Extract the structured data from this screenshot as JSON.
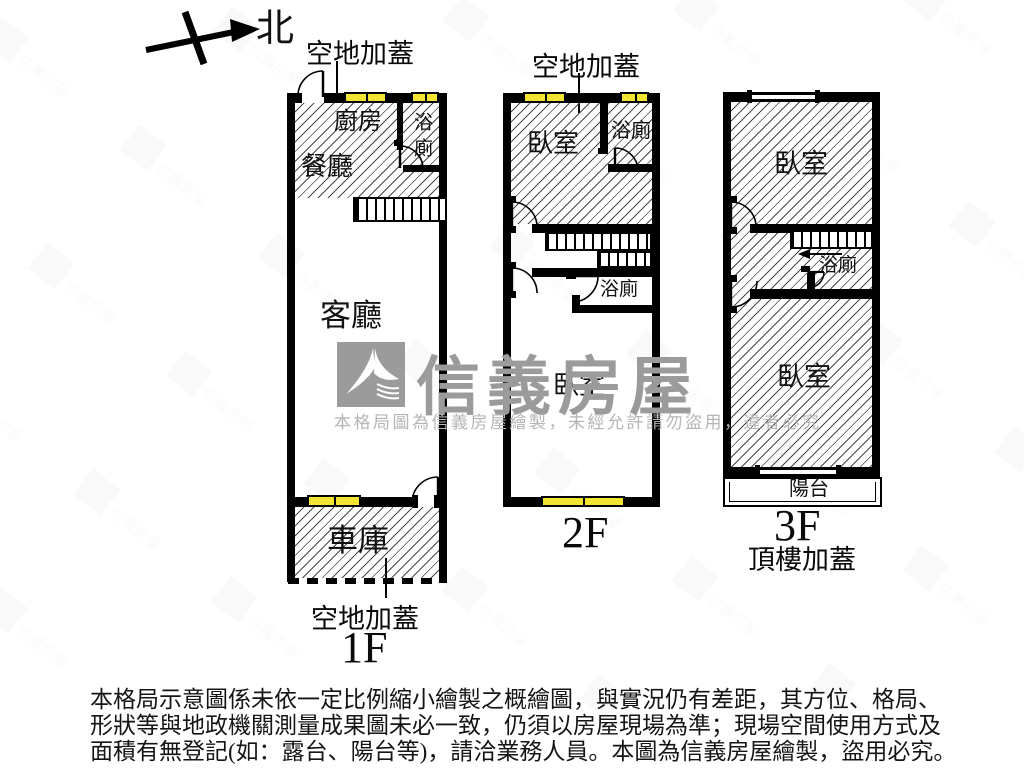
{
  "compass": {
    "north_label": "北"
  },
  "floor1": {
    "label": "1F",
    "annotation_top": "空地加蓋",
    "annotation_bottom": "空地加蓋",
    "rooms": {
      "kitchen": "廚房",
      "bath": "浴廁",
      "dining": "餐廳",
      "living": "客廳",
      "garage": "車庫"
    }
  },
  "floor2": {
    "label": "2F",
    "annotation_top": "空地加蓋",
    "rooms": {
      "bedroom_front": "臥室",
      "bath_front": "浴廁",
      "bath_mid": "浴廁",
      "bedroom_rear": "臥室"
    }
  },
  "floor3": {
    "label": "3F",
    "annotation_bottom": "頂樓加蓋",
    "rooms": {
      "bedroom_front": "臥室",
      "bath": "浴廁",
      "bedroom_rear": "臥室",
      "balcony": "陽台"
    }
  },
  "watermark": {
    "brand": "信義房屋",
    "notice": "本格局圖為信義房屋繪製，未經允許請勿盜用，違者必究"
  },
  "disclaimer": {
    "line1": "本格局示意圖係未依一定比例縮小繪製之概繪圖，與實況仍有差距，其方位、格局、",
    "line2": "形狀等與地政機關測量成果圖未必一致，仍須以房屋現場為準；現場空間使用方式及",
    "line3": "面積有無登記(如：露台、陽台等)，請洽業務人員。本圖為信義房屋繪製，盜用必究。"
  },
  "colors": {
    "wall": "#000000",
    "window_fill": "#f2e432",
    "hatch_line": "#474747",
    "watermark_gray": "#9b9b9b",
    "notice_gray": "#b5b5b5"
  }
}
